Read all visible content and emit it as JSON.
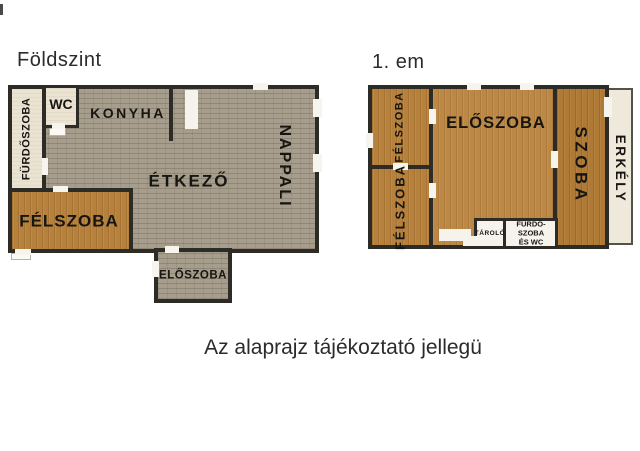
{
  "ground_floor": {
    "title": "Földszint",
    "rooms": {
      "furdoszoba": "FÜRDŐSZOBA",
      "wc": "WC",
      "konyha": "KONYHA",
      "etkezo": "ÉTKEZŐ",
      "nappali": "NAPPALI",
      "felszoba": "FÉLSZOBA",
      "eloszoba": "ELŐSZOBA"
    }
  },
  "first_floor": {
    "title": "1. em",
    "rooms": {
      "felszoba_top": "FÉLSZOBA",
      "felszoba_bottom": "FÉLSZOBA",
      "eloszoba": "ELŐSZOBA",
      "szoba": "SZOBA",
      "erkely": "ERKÉLY",
      "tarolo": "TÁROLÓ",
      "furdoszoba_wc": "FÜRDŐ-SZOBA ÉS WC"
    }
  },
  "footer": {
    "note": "Az alaprajz tájékoztató jellegü"
  },
  "colors": {
    "wall": "#2d2b26",
    "stone_floor": "#a69d8c",
    "wood_floor": "#b5813c",
    "cream_room": "#ebe3d2",
    "white_room": "#f6f3ec",
    "background": "#ffffff"
  }
}
